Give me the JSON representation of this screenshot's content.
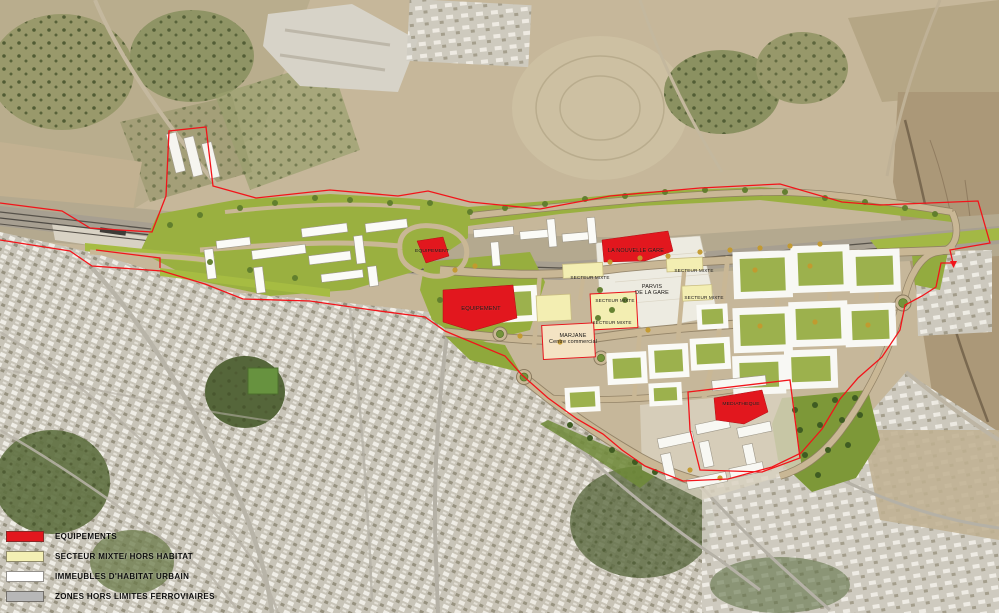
{
  "legend": {
    "items": [
      {
        "id": "equipements",
        "label": "EQUIPEMENTS",
        "color": "#e2171e"
      },
      {
        "id": "secteur-mixte",
        "label": "SECTEUR MIXTE/ HORS HABITAT",
        "color": "#f3efb4"
      },
      {
        "id": "immeubles-habitat",
        "label": "IMMEUBLES D'HABITAT URBAIN",
        "color": "#ffffff"
      },
      {
        "id": "zones-hors-limites",
        "label": "ZONES HORS LIMITES FERROVIAIRES",
        "color": "#b7b7b7"
      }
    ]
  },
  "plan_labels": {
    "equipement_nord": "EQUIPEMENT",
    "nouvelle_gare": "LA NOUVELLE GARE",
    "secteur_mixte_a": "SECTEUR MIXTE",
    "secteur_mixte_b": "SECTEUR MIXTE",
    "parvis_line1": "PARVIS",
    "parvis_line2": "DE LA GARE",
    "secteur_mixte_c": "SECTEUR MIXTE",
    "secteur_mixte_d": "SECTEUR MIXTE",
    "equipement": "EQUIPEMENT",
    "secteur_mixte_e": "SECTEUR MIXTE",
    "marjane_line1": "MARJANE",
    "marjane_line2": "Centre commercial",
    "mediatheque": "MEDIATHEQUE"
  },
  "map_colors": {
    "boundary_red": "#f2141a",
    "equipment_red": "#e2171e",
    "park_green": "#9ab040",
    "plan_road_tan": "#c9b795",
    "mixte_yellow": "#f3eeb2",
    "marjane_beige": "#f4e3c3"
  }
}
